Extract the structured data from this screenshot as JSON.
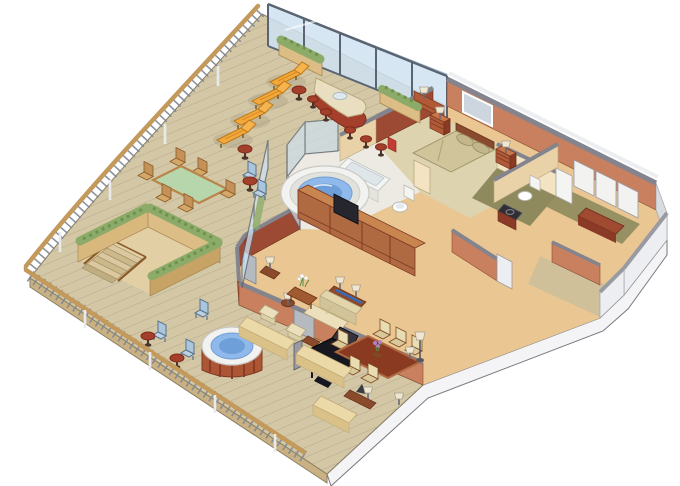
{
  "scene": {
    "type": "isometric-cutaway-floor-plan",
    "subject": "luxury penthouse suite with wrap-around teak deck",
    "view": "3d-isometric",
    "canvas": {
      "width": 680,
      "height": 486,
      "background": "#ffffff"
    },
    "rooms": [
      {
        "name": "master-bedroom",
        "furniture": [
          "king-bed",
          "pillows",
          "headboard-mirror",
          "nightstand-left",
          "nightstand-right",
          "table-lamps",
          "dresser"
        ]
      },
      {
        "name": "master-bathroom",
        "furniture": [
          "bathtub",
          "toilet",
          "whirlpool-tub-in-glass-enclosure",
          "red-towel",
          "marble-floor"
        ]
      },
      {
        "name": "living-room",
        "furniture": [
          "entertainment-cabinets",
          "television",
          "wall-tv",
          "sofa",
          "console-table-with-lamps",
          "armchair-pair",
          "coffee-table-white-flowers",
          "side-tables",
          "grand-piano",
          "piano-bench",
          "floor-lamps",
          "glass-door"
        ]
      },
      {
        "name": "dining-area",
        "furniture": [
          "dining-table",
          "six-dining-chairs",
          "purple-flower-centerpiece",
          "console-desk",
          "post-lamps"
        ]
      },
      {
        "name": "guest-bathroom",
        "furniture": [
          "toilet",
          "dark-vanity-sink",
          "door"
        ]
      },
      {
        "name": "wardrobe-closet",
        "furniture": [
          "bifold-doors",
          "bench"
        ]
      },
      {
        "name": "entry-vestibule",
        "furniture": [
          "white-walls",
          "accent-wall"
        ]
      }
    ],
    "deck": {
      "name": "wrap-around-teak-deck",
      "features": [
        "curved-wood-railing",
        "glass-windscreen",
        "planter-boxes",
        "four-chaise-lounges",
        "lounge-side-tables",
        "wet-bar-with-sink",
        "five-bar-stools",
        "outdoor-dining-table-glass-top",
        "six-outdoor-chairs",
        "hedge-enclosed-private-stair",
        "staircase",
        "blue-folding-deck-chairs",
        "round-cocktail-tables",
        "outdoor-hot-tub",
        "deck-cushion-benches",
        "glass-partition"
      ]
    }
  },
  "palette": {
    "background": "#ffffff",
    "deck_wood": "#d3c7a6",
    "plank_line": "#ab9f80",
    "deck_fascia": "#c9b183",
    "railing_wood": "#c49a5c",
    "baluster": "#7d8795",
    "glass": "#cfe2f2",
    "glass_frame": "#5a6472",
    "wall_light": "#c8805f",
    "wall_dark": "#9c4a33",
    "wall_cap": "#84848e",
    "cream_wall": "#f3e3c3",
    "cream_wall_dark": "#e9d2a8",
    "white_wall": "#eceef1",
    "white_wall_dark": "#d9dcdf",
    "slab_side": "#f4f4f6",
    "carpet_living": "#eac792",
    "carpet_bed": "#ddd3ae",
    "floor_marble": "#eceae2",
    "floor_olive": "#8e8a5e",
    "floor_entry": "#cfc09a",
    "water": "#8fb9ea",
    "water_deep": "#6f9fd8",
    "tub_white": "#f2f2f0",
    "tub_base": "#ad5636",
    "hedge": "#8cab68",
    "planter_tan": "#dcbd85",
    "planter_side": "#c8a366",
    "lounger_orange": "#f2a93b",
    "bar_body": "#a33f2a",
    "bar_top": "#e9dec0",
    "table_green": "#b7d6ac",
    "chair_wood": "#c49258",
    "sofa_cream": "#ece0bc",
    "wood_brown": "#a05a32",
    "piano_black": "#17171f",
    "tv_blue": "#4a86c8",
    "blue_chair": "#aac6de",
    "flower_purple": "#b080c8"
  }
}
